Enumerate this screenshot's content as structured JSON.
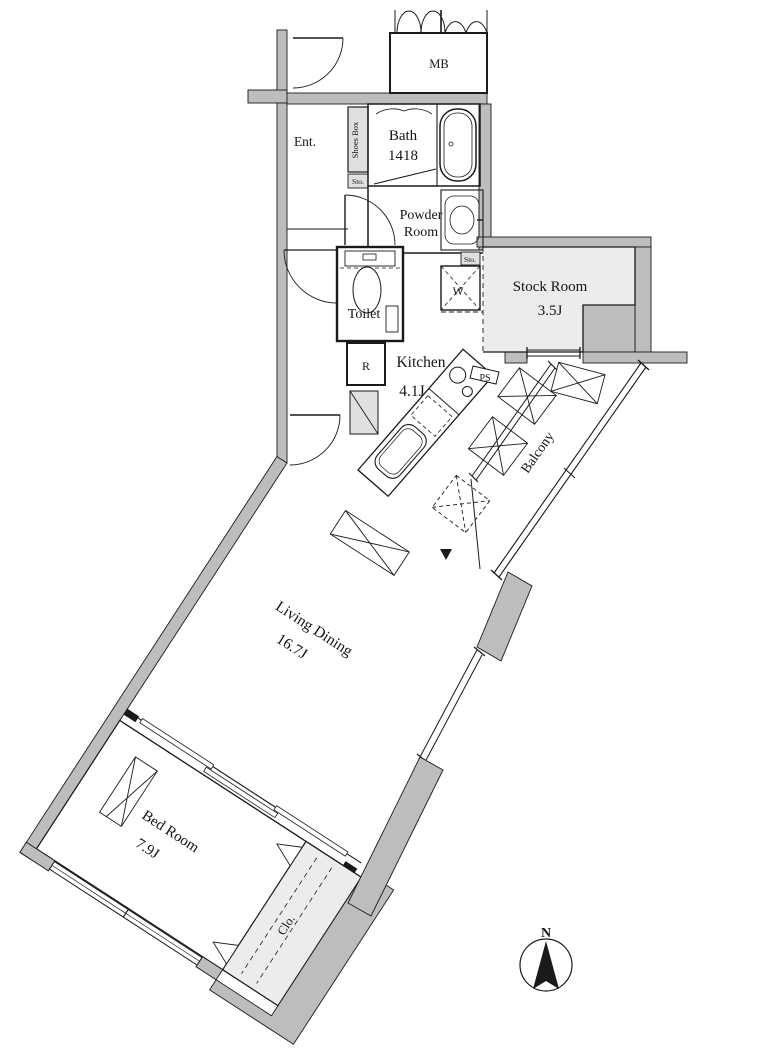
{
  "plan_title": "1LDK apartment floor plan",
  "colors": {
    "wall_fill": "#bdbdbd",
    "light_room_fill": "#ececec",
    "cabinet_fill": "#e0e0e0",
    "line": "#1a1a1a",
    "background": "#ffffff"
  },
  "rooms": {
    "meter_box": {
      "label": "MB"
    },
    "entrance": {
      "label": "Ent."
    },
    "shoes_box": {
      "label": "Shoes Box"
    },
    "storage_small_upper": {
      "label": "Sto."
    },
    "storage_small_lower": {
      "label": "Sto."
    },
    "bath": {
      "name": "Bath",
      "size": "1418"
    },
    "powder_room": {
      "name_line1": "Powder",
      "name_line2": "Room"
    },
    "toilet": {
      "label": "Toilet"
    },
    "washer_space": {
      "label": "W"
    },
    "refrigerator_space": {
      "label": "R"
    },
    "kitchen": {
      "name": "Kitchen",
      "size": "4.1J"
    },
    "pipe_space": {
      "label": "PS"
    },
    "stock_room": {
      "name": "Stock Room",
      "size": "3.5J"
    },
    "balcony": {
      "label": "Balcony"
    },
    "living_dining": {
      "name": "Living Dining",
      "size": "16.7J"
    },
    "bed_room": {
      "name": "Bed Room",
      "size": "7.9J"
    },
    "closet": {
      "label": "Clo."
    }
  },
  "compass": {
    "label": "N"
  }
}
